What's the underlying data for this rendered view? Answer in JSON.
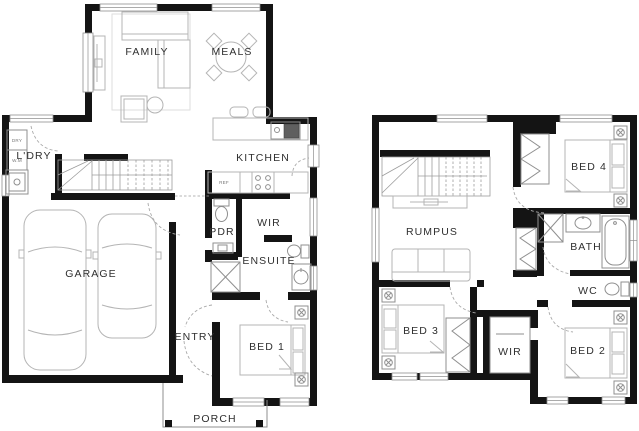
{
  "plan": {
    "ground_floor": {
      "family": "FAMILY",
      "meals": "MEALS",
      "kitchen": "KITCHEN",
      "laundry": "L'DRY",
      "dryer": "DRY",
      "washer": "W.M",
      "fridge": "REF",
      "powder": "PDR",
      "wir": "WIR",
      "ensuite": "ENSUITE",
      "garage": "GARAGE",
      "entry": "ENTRY",
      "bed1": "BED 1",
      "porch": "PORCH"
    },
    "upper_floor": {
      "rumpus": "RUMPUS",
      "bed4": "BED 4",
      "bath": "BATH",
      "wc": "WC",
      "bed3": "BED 3",
      "wir": "WIR",
      "bed2": "BED 2"
    },
    "colors": {
      "wall": "#141414",
      "furniture_line": "#b4b4b4",
      "fixture_line": "#8f8f8f",
      "label_text": "#2f2f2f",
      "appliance_dark": "#5f5f5f",
      "background": "#ffffff"
    }
  }
}
